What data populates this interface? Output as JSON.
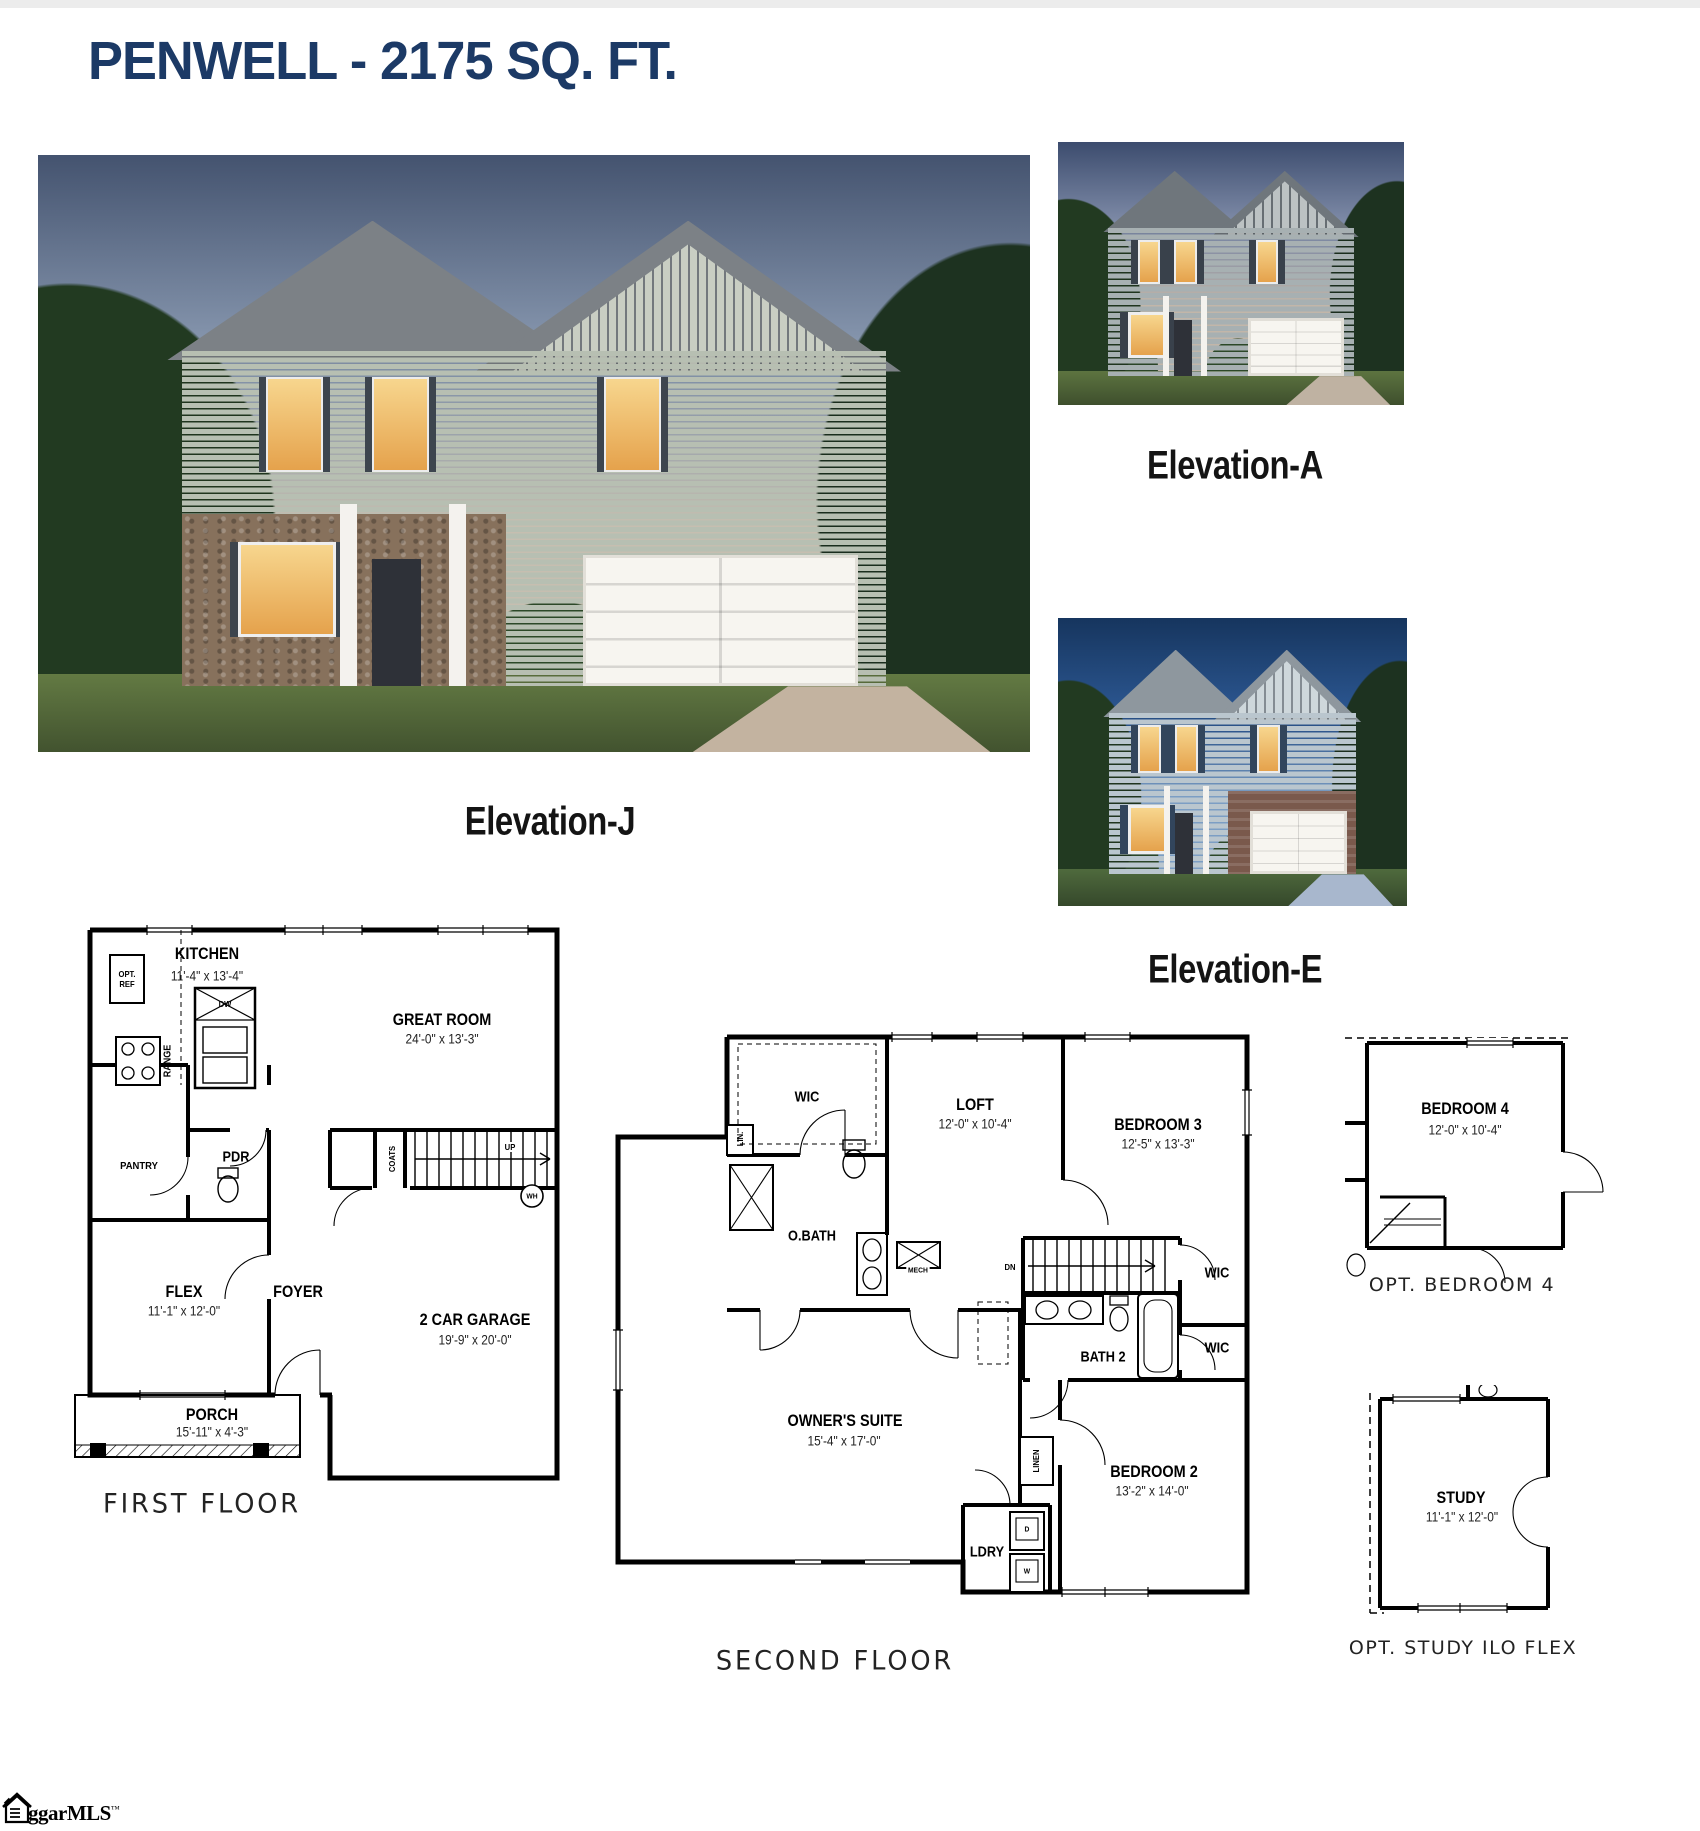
{
  "page": {
    "title": "PENWELL - 2175 SQ. FT.",
    "logo_text": "ggarMLS",
    "logo_tm": "™"
  },
  "elevations": {
    "j": "Elevation-J",
    "a": "Elevation-A",
    "e": "Elevation-E"
  },
  "first_floor": {
    "caption": "FIRST FLOOR",
    "kitchen": "KITCHEN",
    "kitchen_dims": "11'-4\" x 13'-4\"",
    "great_room": "GREAT ROOM",
    "great_room_dims": "24'-0\" x 13'-3\"",
    "flex": "FLEX",
    "flex_dims": "11'-1\" x 12'-0\"",
    "garage": "2 CAR GARAGE",
    "garage_dims": "19'-9\" x 20'-0\"",
    "porch": "PORCH",
    "porch_dims": "15'-11\" x 4'-3\"",
    "foyer": "FOYER",
    "pantry": "PANTRY",
    "pdr": "PDR",
    "coats": "COATS",
    "opt_ref": "OPT. REF",
    "range": "RANGE",
    "dw": "DW",
    "up": "UP",
    "wh": "WH"
  },
  "second_floor": {
    "caption": "SECOND FLOOR",
    "wic": "WIC",
    "wic2": "WIC",
    "wic3": "WIC",
    "lin": "LIN.",
    "linen": "LINEN",
    "loft": "LOFT",
    "loft_dims": "12'-0\" x 10'-4\"",
    "bedroom3": "BEDROOM 3",
    "bedroom3_dims": "12'-5\" x 13'-3\"",
    "owners_suite": "OWNER'S SUITE",
    "owners_suite_dims": "15'-4\" x 17'-0\"",
    "bedroom2": "BEDROOM 2",
    "bedroom2_dims": "13'-2\" x 14'-0\"",
    "obath": "O.BATH",
    "bath2": "BATH 2",
    "mech": "MECH",
    "dn": "DN",
    "ldry": "LDRY",
    "dryer": "D",
    "washer": "W"
  },
  "options": {
    "bedroom4": "BEDROOM 4",
    "bedroom4_dims": "12'-0\" x 10'-4\"",
    "bedroom4_caption": "OPT. BEDROOM 4",
    "study": "STUDY",
    "study_dims": "11'-1\" x 12'-0\"",
    "study_caption": "OPT. STUDY ILO FLEX"
  }
}
